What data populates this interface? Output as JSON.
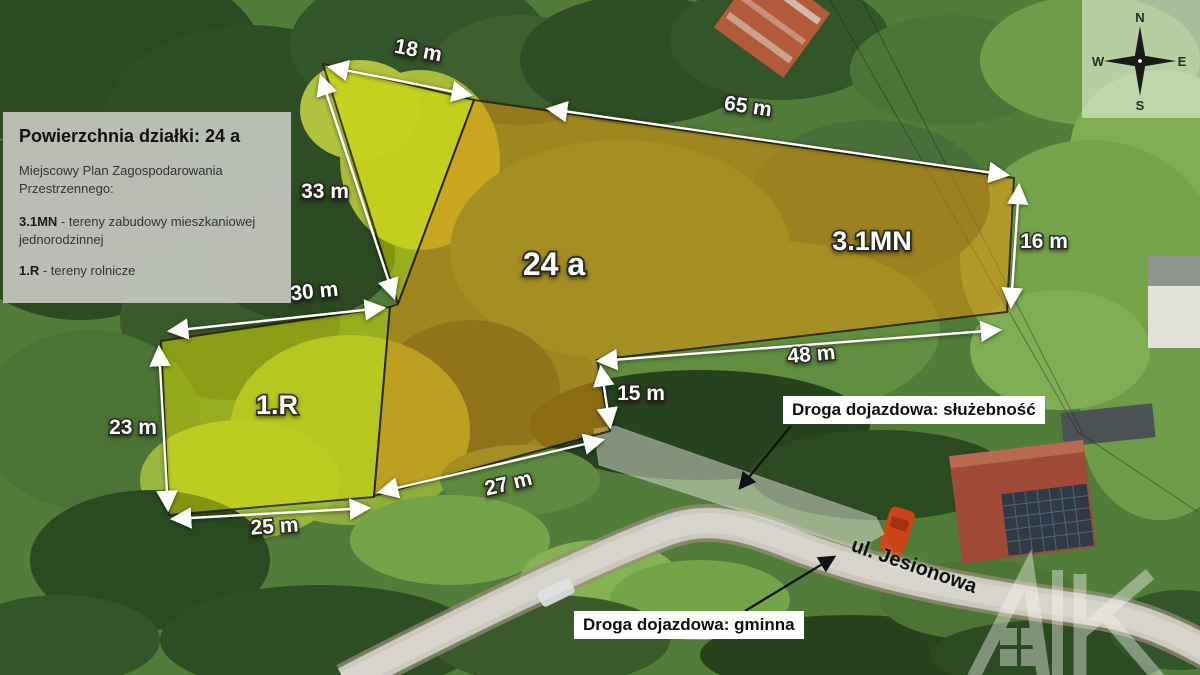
{
  "info_box": {
    "title": "Powierzchnia działki: 24 a",
    "plan_label": "Miejscowy Plan Zagospodarowania Przestrzennego:",
    "zones": [
      {
        "code": "3.1MN",
        "desc": " - tereny zabudowy mieszkaniowej jednorodzinnej"
      },
      {
        "code": "1.R",
        "desc": " - tereny rolnicze"
      }
    ]
  },
  "measurements": {
    "m18": "18 m",
    "m65": "65 m",
    "m33": "33 m",
    "m30": "30 m",
    "m16": "16 m",
    "m48": "48 m",
    "m15": "15 m",
    "m23": "23 m",
    "m25": "25 m",
    "m27": "27 m"
  },
  "parcels": {
    "area_label": "24 a",
    "zone_mn_label": "3.1MN",
    "zone_r_label": "1.R"
  },
  "roads": {
    "easement_label": "Droga dojazdowa: służebność",
    "street_label": "ul. Jesionowa",
    "municipal_label": "Droga dojazdowa: gminna"
  },
  "compass": {
    "n": "N",
    "e": "E",
    "s": "S",
    "w": "W"
  },
  "watermark_letters": "AK",
  "colors": {
    "zone_r_fill": "#dde002",
    "zone_mn_fill": "#e8920a",
    "dimension_arrow": "#ffffff",
    "annotation_arrow": "#111111",
    "label_box_bg": "#ffffff",
    "info_box_bg": "#d0d0cc"
  }
}
